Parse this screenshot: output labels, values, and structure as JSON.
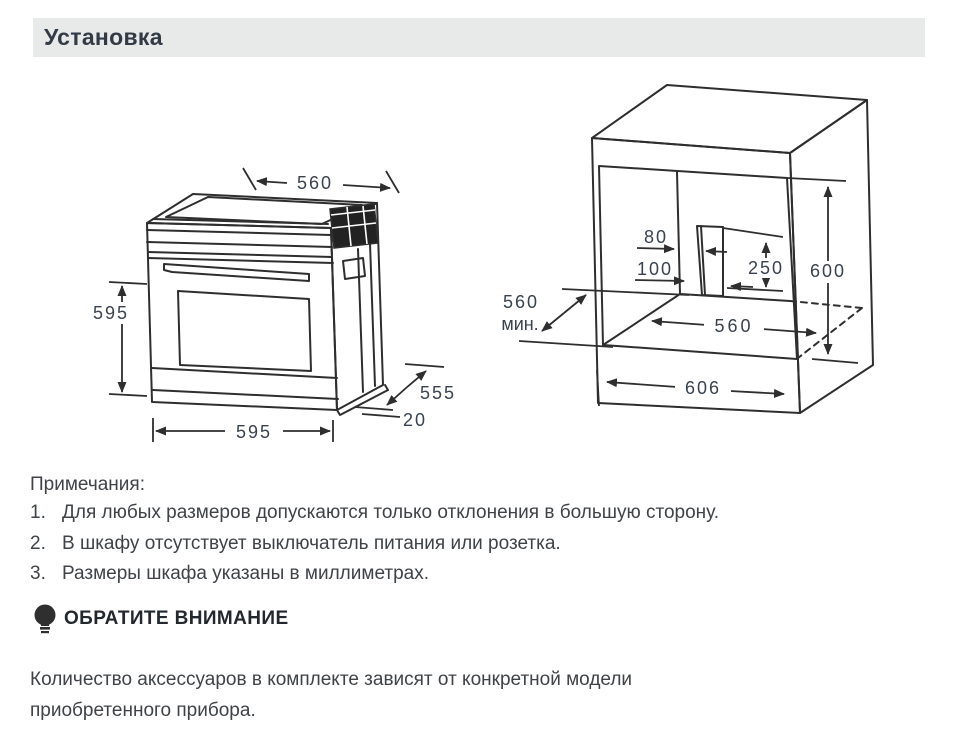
{
  "header": {
    "title": "Установка"
  },
  "oven_diagram": {
    "dim_top_width": "560",
    "dim_height": "595",
    "dim_bottom_width": "595",
    "dim_depth": "555",
    "dim_lip": "20"
  },
  "cabinet_diagram": {
    "dim_slot_upper": "80",
    "dim_slot_lower": "100",
    "dim_slot_height": "250",
    "dim_niche_height": "600",
    "dim_inner_width": "560",
    "dim_outer_width": "606",
    "dim_min_depth_value": "560",
    "dim_min_depth_unit": "мин."
  },
  "notes": {
    "title": "Примечания:",
    "items": [
      {
        "num": "1.",
        "text": "Для любых размеров допускаются только отклонения в большую сторону."
      },
      {
        "num": "2.",
        "text": "В шкафу отсутствует выключатель питания или розетка."
      },
      {
        "num": "3.",
        "text": "Размеры шкафа указаны в миллиметрах."
      }
    ]
  },
  "attention": {
    "title": "ОБРАТИТЕ ВНИМАНИЕ",
    "body": "Количество аксессуаров в комплекте зависят от конкретной модели приобретенного прибора."
  },
  "colors": {
    "header_bg": "#e8eaea",
    "line": "#2e2e2e",
    "dim_text": "#39434f",
    "body_text": "#3f4347"
  }
}
